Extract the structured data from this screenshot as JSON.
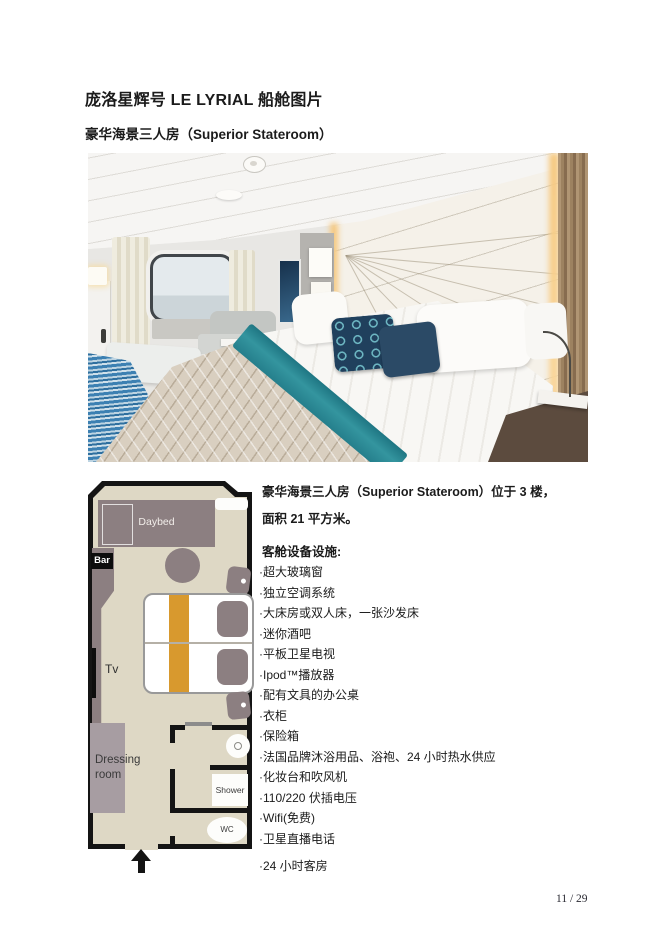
{
  "page": {
    "title": "庞洛星辉号 LE LYRIAL 船舱图片",
    "subtitle": "豪华海景三人房（Superior Stateroom）",
    "page_number": "11 / 29"
  },
  "cabin_info": {
    "intro_line1": "豪华海景三人房（Superior Stateroom）位于 3 楼，",
    "intro_line2": "面积 21 平方米。",
    "amenities_heading": "客舱设备设施:",
    "amenities": [
      "·超大玻璃窗",
      "·独立空调系统",
      "·大床房或双人床，一张沙发床",
      "·迷你酒吧",
      "·平板卫星电视",
      "·Ipod™播放器",
      "·配有文具的办公桌",
      "·衣柜",
      "·保险箱",
      "·法国品牌沐浴用品、浴袍、24 小时热水供应",
      "·化妆台和吹风机",
      "·110/220 伏插电压",
      "·Wifi(免费)",
      "·卫星直播电话",
      "·24 小时客房"
    ]
  },
  "floor_plan": {
    "labels": {
      "daybed": "Daybed",
      "bar": "Bar",
      "tv": "Tv",
      "dressing_room": "Dressing room",
      "shower": "Shower",
      "wc": "WC"
    },
    "colors": {
      "floor": "#ded8c5",
      "furniture": "#8c7f81",
      "dressing": "#a79da2",
      "bed_runner": "#d8992e",
      "wall": "#141414"
    }
  },
  "photo": {
    "colors": {
      "bed_runner_teal": "#2e8f99",
      "accent_pillow_navy": "#20405d",
      "quilt_beige": "#d9cfc0",
      "carpet_blue": "#3c80b2",
      "light_glow": "#f6c87e"
    }
  }
}
